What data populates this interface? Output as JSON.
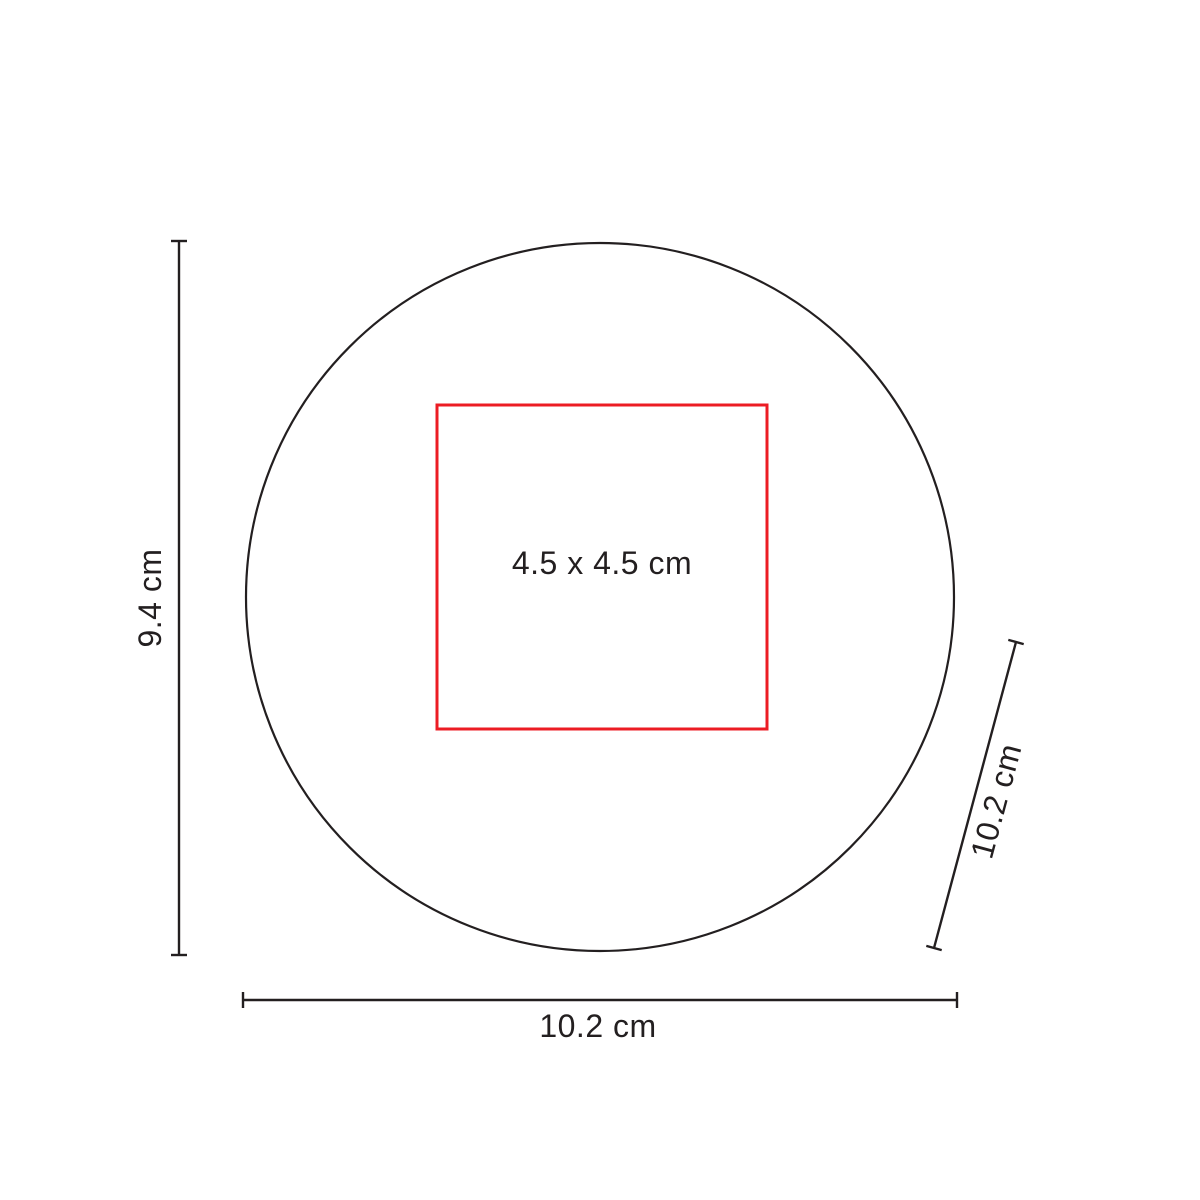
{
  "diagram": {
    "type": "product-dimension-spec",
    "shape": "circle",
    "imprint_area": {
      "label": "4.5 x 4.5 cm",
      "width_cm": 4.5,
      "height_cm": 4.5
    },
    "dimensions": {
      "height_label": "9.4 cm",
      "width_label": "10.2 cm",
      "diagonal_label": "10.2 cm"
    },
    "colors": {
      "line": "#231f20",
      "imprint_outline": "#ec1c24",
      "background": "#ffffff"
    }
  }
}
